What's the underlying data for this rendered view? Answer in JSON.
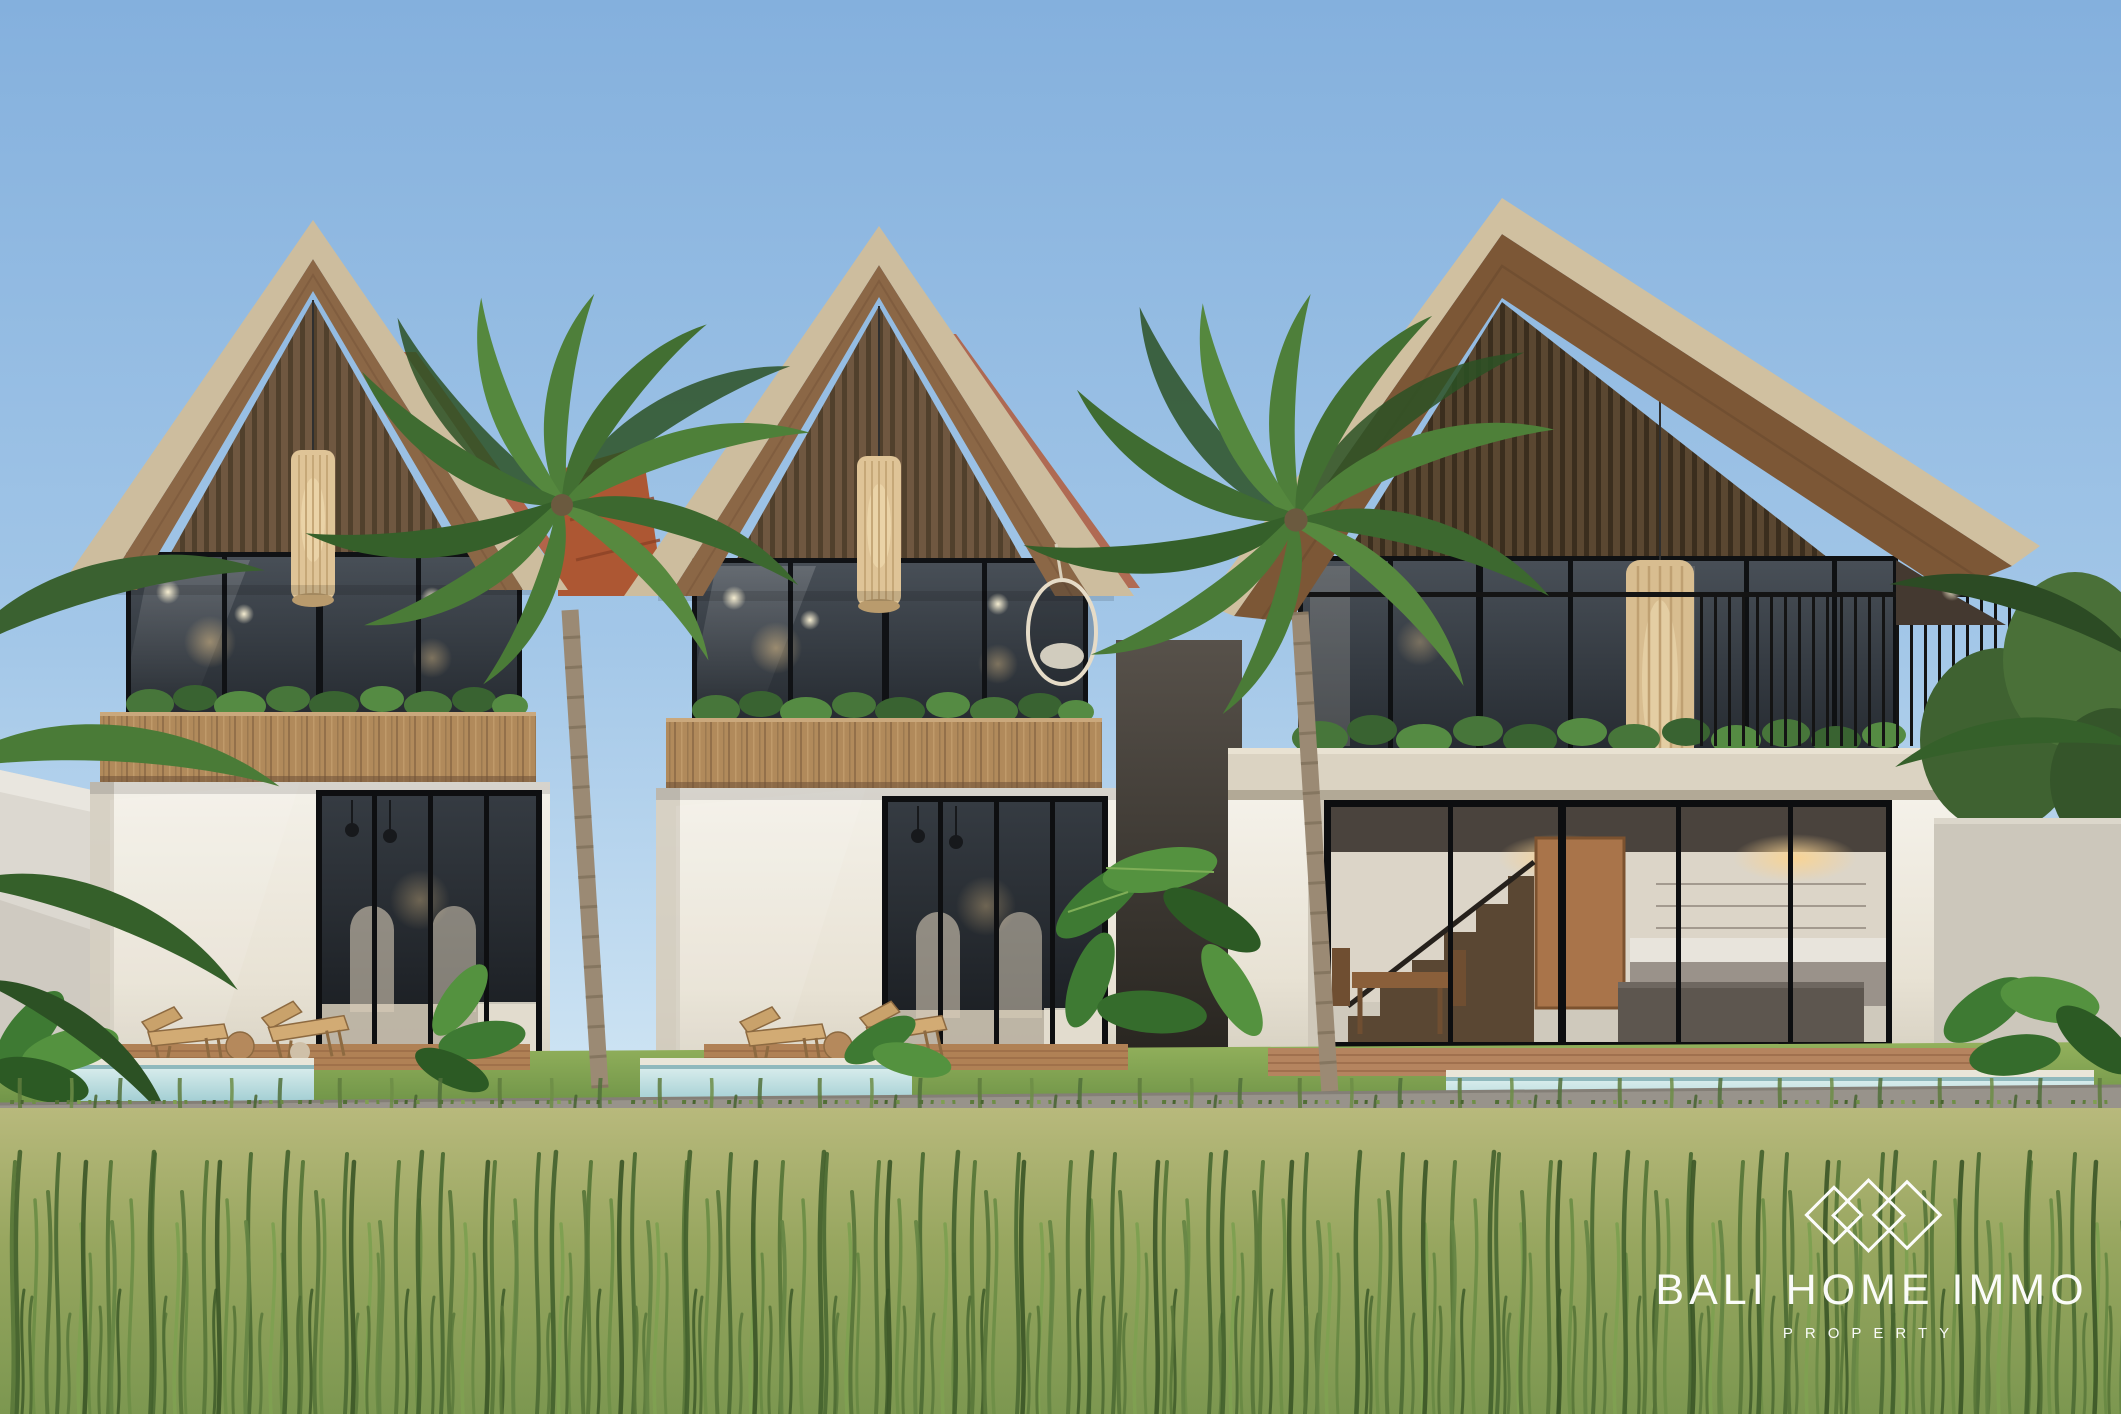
{
  "meta": {
    "title": "Three tropical modern villas – daytime exterior 3D render"
  },
  "logo": {
    "brand": "BALI HOME IMMO",
    "tagline": "PROPERTY",
    "mark": "three-diamond-outline-logo",
    "color": "#ffffff"
  },
  "scene": {
    "description": "Daytime architectural rendering of three modern tropical villas with steep gable roofs, dark timber slat gables, rattan pendant lamps, glass facades, wooden lounge chairs, plunge pools, palm trees, a grey lane and a tall wild grass field in the foreground",
    "villas": [
      {
        "name": "left-villa",
        "storeys": 2,
        "features": [
          "gable roof",
          "rattan pendant lamp",
          "balcony planter",
          "glass sliding doors",
          "two lounge chairs",
          "plunge pool"
        ]
      },
      {
        "name": "middle-villa",
        "storeys": 2,
        "features": [
          "gable roof",
          "rattan pendant lamp",
          "hanging egg chair",
          "glass sliding doors",
          "two lounge chairs",
          "plunge pool"
        ]
      },
      {
        "name": "right-villa",
        "storeys": 2,
        "features": [
          "large asymmetric gable roof",
          "balcony with black railing",
          "open kitchen",
          "wooden staircase",
          "dining set",
          "terracotta pool deck",
          "plunge pool"
        ]
      }
    ],
    "palette": {
      "sky_top": "#84b0dd",
      "sky_horizon": "#d7eaf6",
      "roof_fascia": "#d0c0a0",
      "roof_underside": "#7c5736",
      "gable_slats": "#5a4731",
      "wood_band": "#b18a5b",
      "wall": "#f4f1e9",
      "glass": "#343a40",
      "pool": "#bfdfe1",
      "lawn": "#84a751",
      "road": "#98938b",
      "grass_field": "#9aa762",
      "palm_green": "#4c7f3a",
      "terracotta_roof": "#ad5733"
    }
  }
}
